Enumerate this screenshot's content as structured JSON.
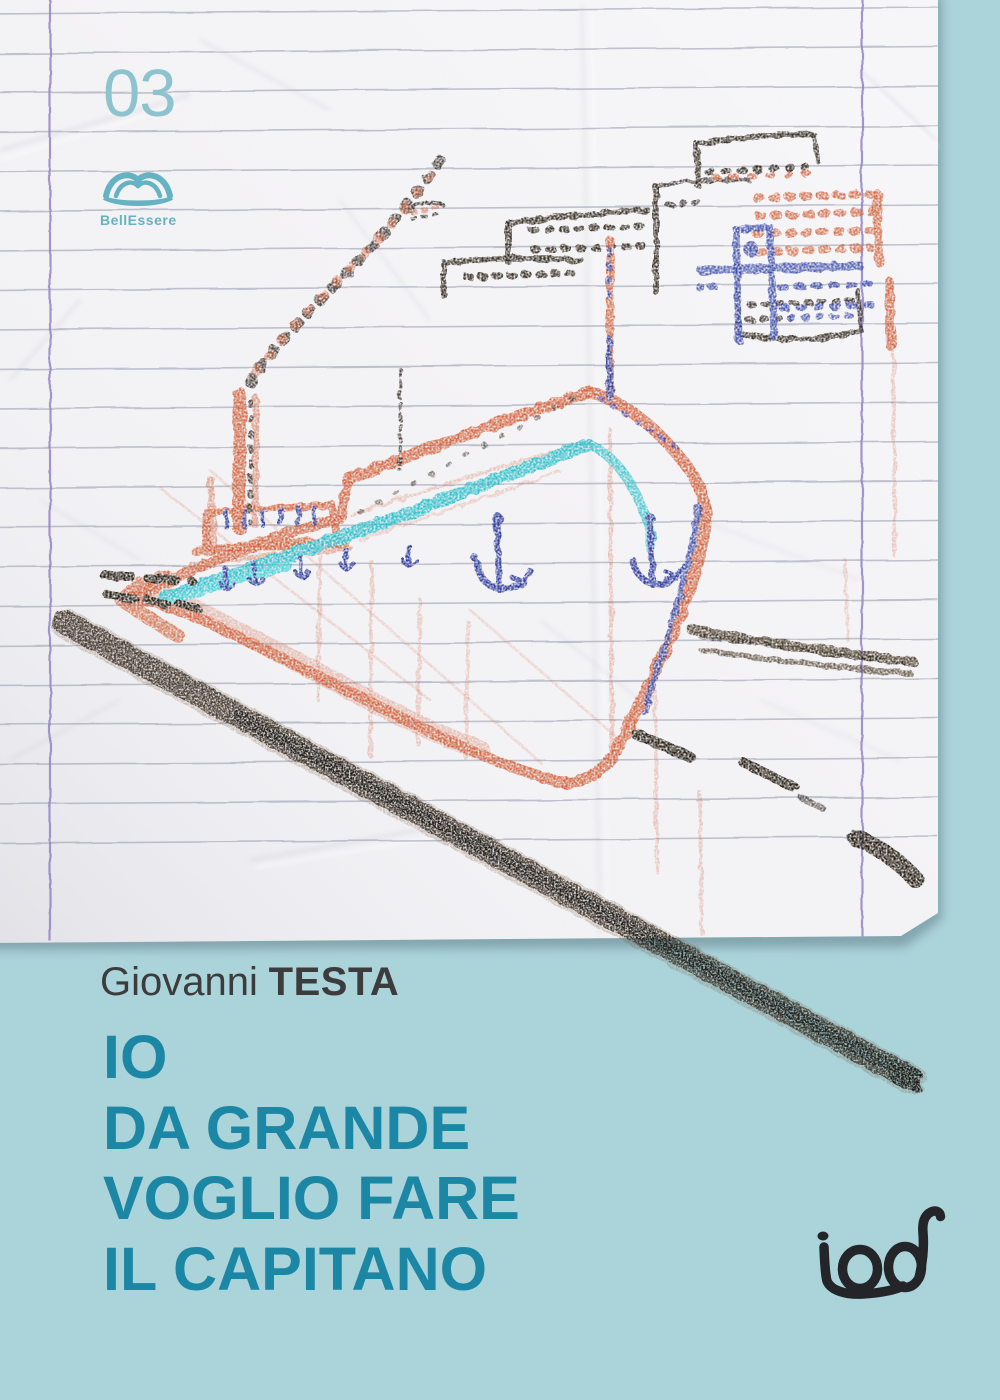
{
  "cover": {
    "series_number": "03",
    "series_logo": {
      "label": "BellEssere",
      "icon": "open-book-icon"
    },
    "author": {
      "first": "Giovanni",
      "last": "TESTA"
    },
    "title_lines": [
      "IO",
      "DA GRANDE",
      "VOGLIO FARE",
      "IL CAPITANO"
    ],
    "publisher": {
      "logo_text": "iod"
    },
    "artwork": {
      "alt": "Child's crayon drawing on crumpled lined notebook paper: a large orange ship with a teal stripe and blue anchors, smoke from its funnel, a harbor city skyline of sketched buildings behind it, and a dark charcoal pier stroke running diagonally off the bottom of the page"
    },
    "colors": {
      "background": "#abd3da",
      "paper": "#f3f2f5",
      "title": "#1c87a4",
      "author": "#3c3c3c",
      "series_number": "#8cc3ce",
      "series_logo": "#64b2c2",
      "publisher": "#232528",
      "crayon_orange": "#d2613a",
      "crayon_teal": "#2bbfca",
      "crayon_navy": "#31419f",
      "crayon_black": "#2b2218",
      "charcoal": "#3a2f24",
      "ruled_line": "#a2a6b6",
      "margin_line": "#8e7ec4"
    }
  }
}
